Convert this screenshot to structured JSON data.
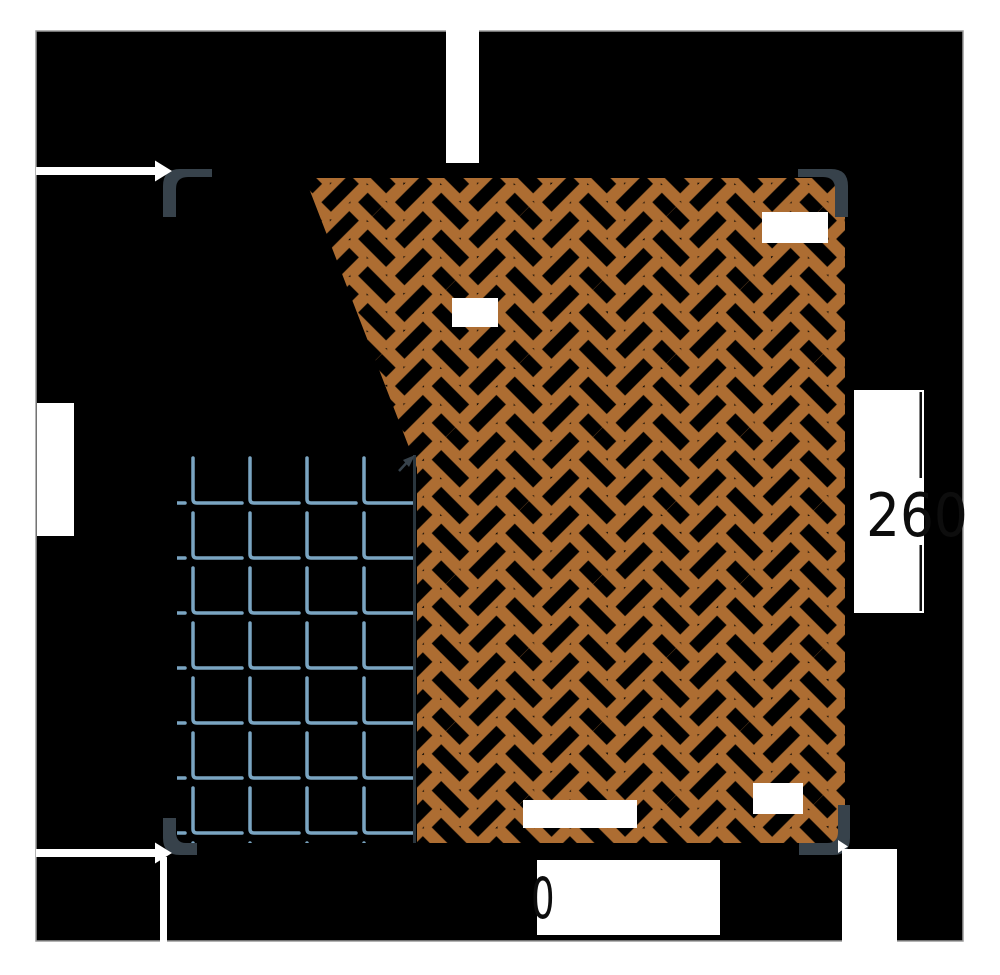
{
  "canvas": {
    "page_background": "#ffffff",
    "background": "#000000",
    "border_color": "#9a9a9a"
  },
  "materials": {
    "parquet": {
      "name": "herringbone-parquet",
      "color": "#AD6D32"
    },
    "tile": {
      "name": "ceramic-tile",
      "color": "#7AA5C2"
    },
    "wall": {
      "name": "wall-corner",
      "color": "#37424B"
    },
    "region_divider_color": "#2a363e"
  },
  "dimensions": {
    "right": {
      "value": "260",
      "line_color": "#0d0d0d"
    },
    "bottom": {
      "value": "0",
      "line_color": "#0d0d0d"
    }
  },
  "icons": {
    "arrow_left_wall": "dimension-arrow-right-icon",
    "arrow_bottom_wall": "dimension-arrow-right-icon",
    "arrow_corner_tip": "dimension-arrow-tip-icon"
  },
  "labels": {
    "empty_box_count": 4
  }
}
